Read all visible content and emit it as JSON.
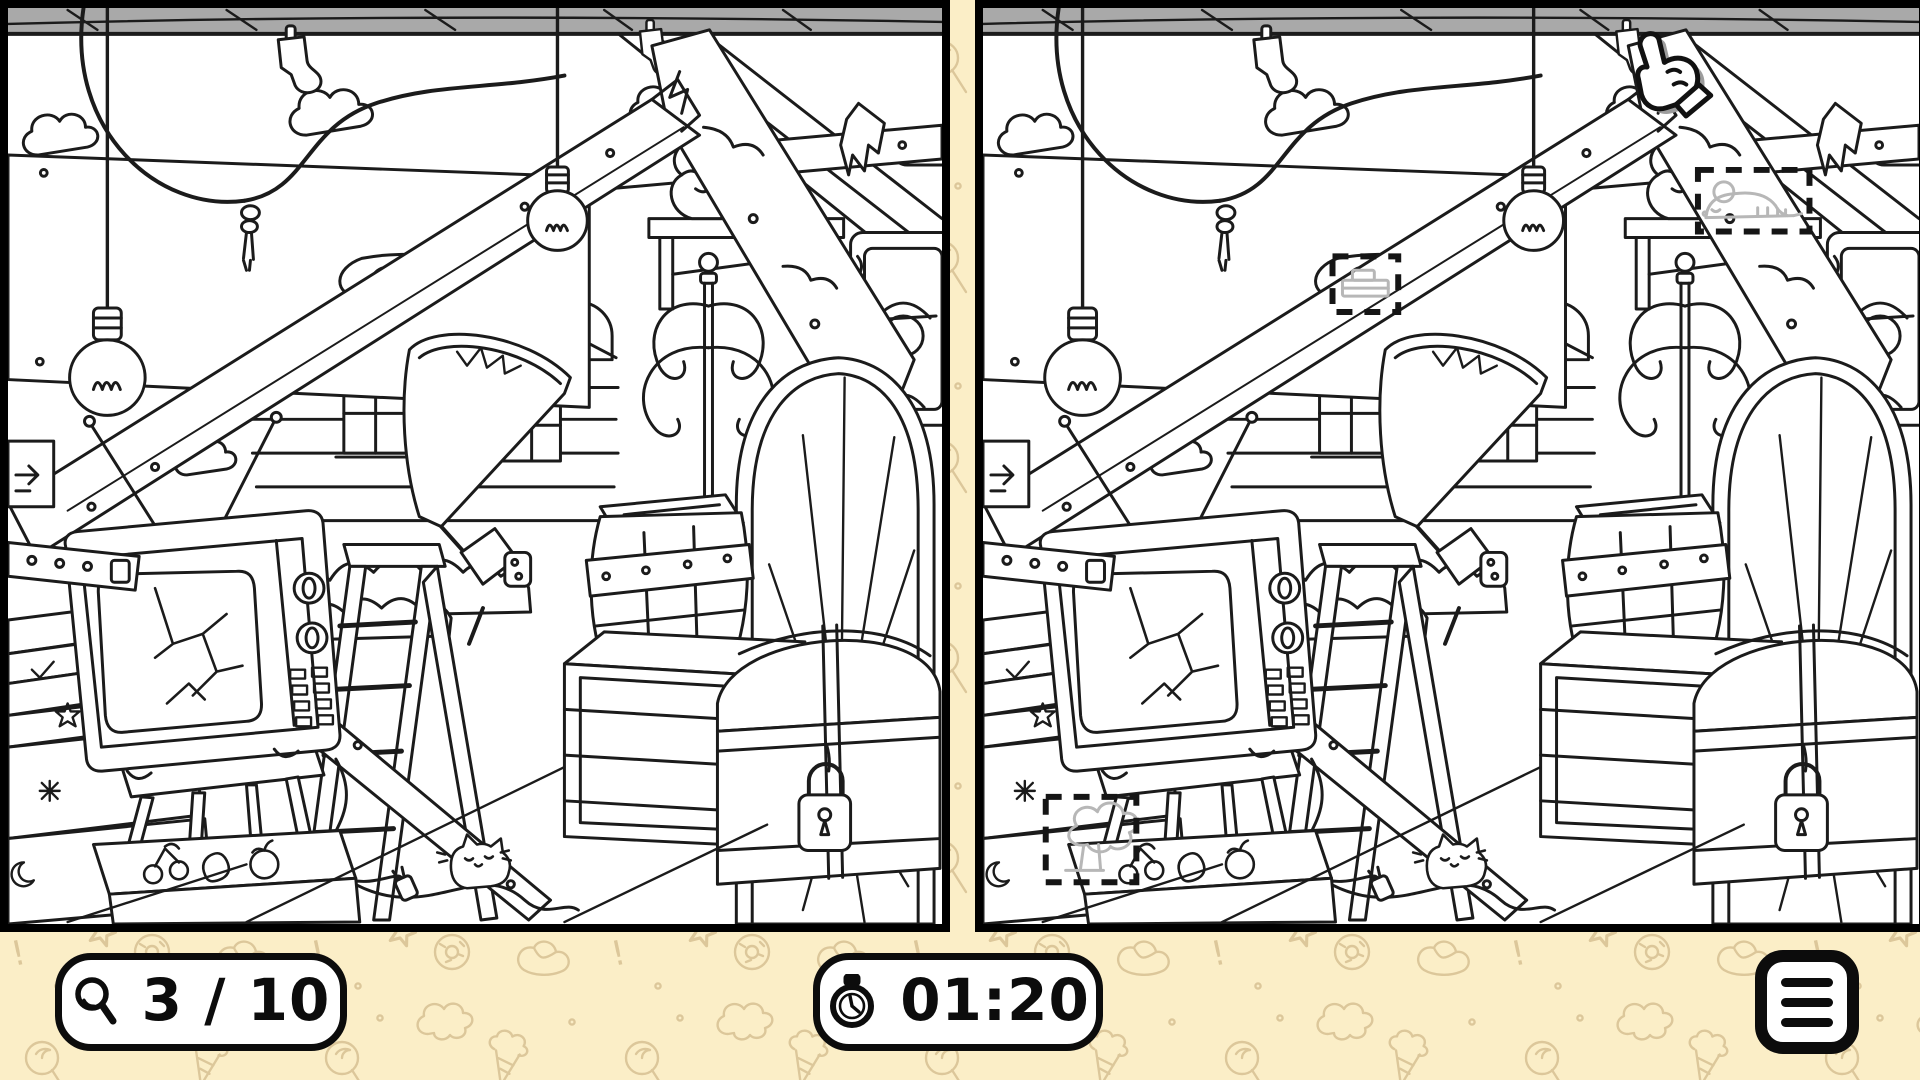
{
  "app": {
    "name": "Find the Differences",
    "screen": "spot-the-difference level"
  },
  "colors": {
    "background": "#FBEEC7",
    "pattern_doodles": "#DCC79A",
    "panel_background": "#FFFFFF",
    "line_art": "#1B1B1B",
    "panel_border": "#000000",
    "hud_border": "#0C0C0C",
    "found_marker_dash": "#151515",
    "faded_found_difference": "#B7B7B7",
    "top_beam_gray": "#A9A9A9"
  },
  "hud": {
    "found_counter": {
      "icon": "magnifier-icon",
      "found": 3,
      "total": 10,
      "display": "3 / 10"
    },
    "timer": {
      "icon": "stopwatch-icon",
      "display": "01:20"
    },
    "menu_button": {
      "icon": "hamburger-menu-icon"
    }
  },
  "background_pattern_doodles": [
    "lollipop",
    "star",
    "donut",
    "pretzel",
    "ice-cream-cone",
    "question-mark",
    "exclamation-mark",
    "popcorn-cloud",
    "dot"
  ],
  "game": {
    "mode": "spot-the-difference",
    "panels": [
      {
        "id": "left",
        "name": "original-scene"
      },
      {
        "id": "right",
        "name": "modified-scene"
      }
    ],
    "scene_objects": [
      "broken-tv-on-stool",
      "tv-antenna",
      "wooden-barrel",
      "wooden-crate",
      "treasure-chest-with-padlock",
      "step-ladder",
      "cracked-arched-mirror",
      "coat-rack",
      "hanging-light-bulb-left",
      "hanging-light-bulb-center",
      "hanging-rope-with-knot",
      "wall-shelf",
      "gargoyle-on-shelf",
      "ornate-picture-frame",
      "torn-lampshade-lamp",
      "diagonal-wooden-beam",
      "broken-plank",
      "roof-rafters",
      "torn-cloth",
      "house-windows",
      "bushes",
      "clouds",
      "hanging-socks",
      "book-stack",
      "fruit-doodle-box",
      "cat-doodle",
      "power-plug-wire",
      "arrow-sign",
      "strap-with-holes"
    ],
    "found_differences": [
      {
        "name": "mouse-on-shelf",
        "panel": "right",
        "box": {
          "x": 718,
          "y": 163,
          "w": 112,
          "h": 62
        }
      },
      {
        "name": "small-box-on-roof",
        "panel": "right",
        "box": {
          "x": 351,
          "y": 250,
          "w": 66,
          "h": 56
        }
      },
      {
        "name": "tree-doodle-on-box",
        "panel": "right",
        "box": {
          "x": 63,
          "y": 794,
          "w": 91,
          "h": 86
        }
      }
    ],
    "cursor": {
      "name": "pointer-hand-cursor",
      "panel": "right",
      "x": 636,
      "y": 24
    }
  }
}
